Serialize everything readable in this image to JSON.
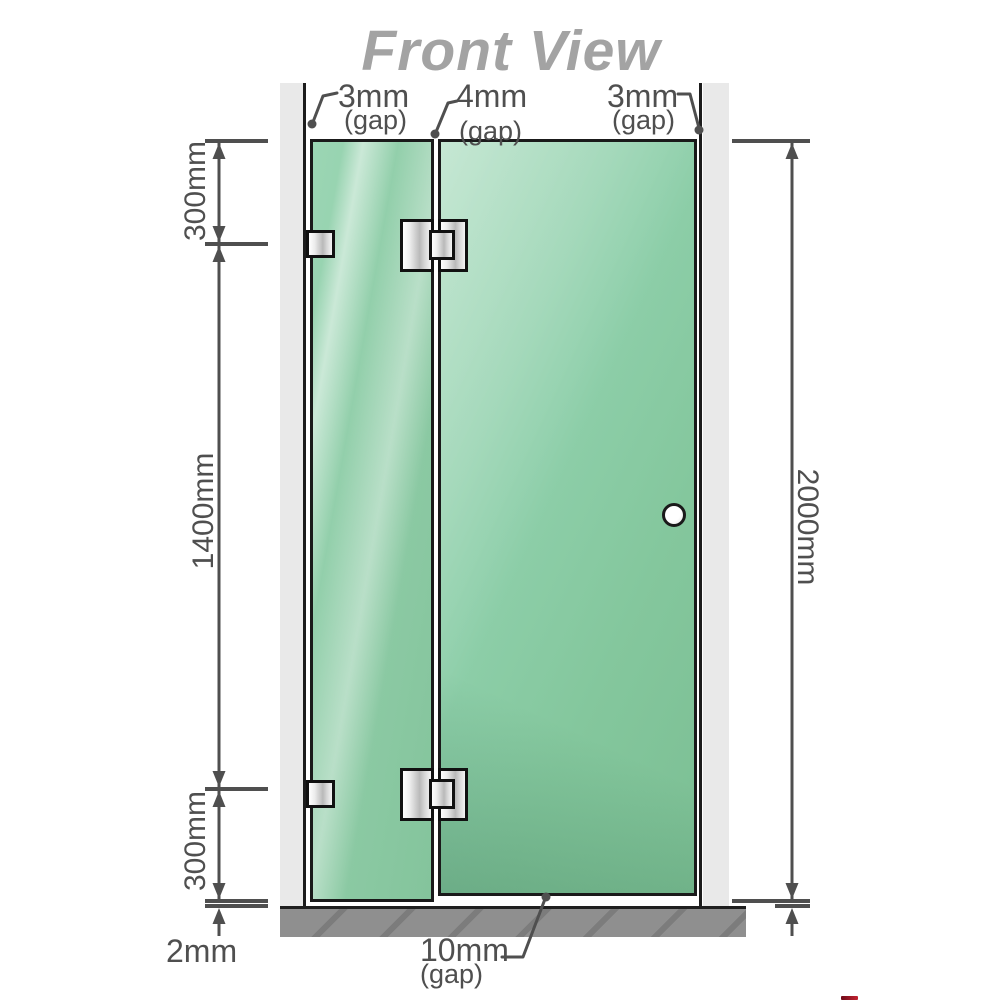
{
  "title": "Front View",
  "annotations": {
    "gap_top_left": {
      "value": "3mm",
      "note": "(gap)"
    },
    "gap_top_middle": {
      "value": "4mm",
      "note": "(gap)"
    },
    "gap_top_right": {
      "value": "3mm",
      "note": "(gap)"
    },
    "gap_bottom": {
      "value": "10mm",
      "note": "(gap)"
    },
    "floor_gap": {
      "value": "2mm"
    }
  },
  "dimensions": {
    "left_top": "300mm",
    "left_middle": "1400mm",
    "left_bottom": "300mm",
    "right_full_height": "2000mm"
  },
  "colors": {
    "glass": "#8ecdaa",
    "glass_border": "#1a1a1a",
    "wall": "#e9e9e9",
    "floor": "#8e8e8e",
    "dimension_line": "#4f4f4f",
    "title_text": "#a3a3a3",
    "metal_fitting": "#d9d9d9",
    "logo_red": "#a01225"
  }
}
